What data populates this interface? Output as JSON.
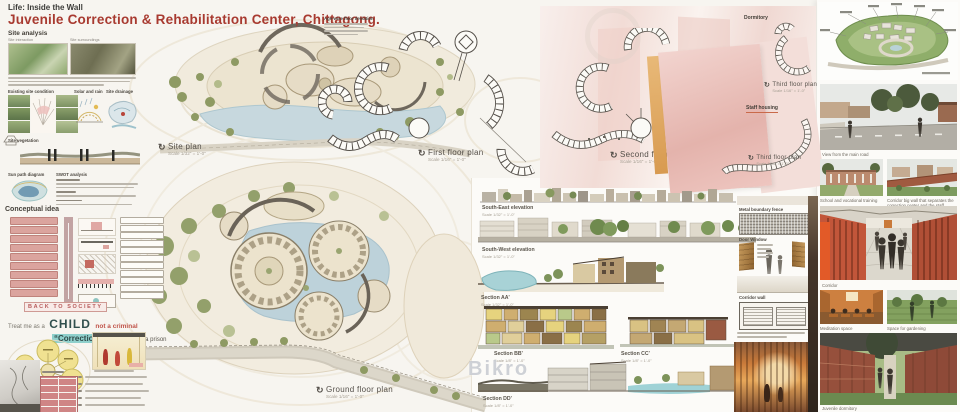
{
  "header": {
    "supertitle": "Life: Inside the Wall",
    "title": "Juvenile Correction & Rehabilitation Center, Chittagong."
  },
  "site_analysis": {
    "heading": "Site analysis",
    "thumb1_label": "Site interaction",
    "thumb2_label": "Site surroundings",
    "existing": "Existing site condition",
    "solar": "Solar and rain",
    "drainage": "Site drainage",
    "vegetation": "Site vegetation",
    "sunpath": "Sun path diagram",
    "swot": "SWOT analysis"
  },
  "conceptual": {
    "heading": "Conceptual idea",
    "back_to_society": "BACK TO SOCIETY",
    "treat_prefix": "Treat me as a",
    "treat_child": "CHILD",
    "treat_suffix": "not a criminal",
    "quote": "“Correction center”",
    "quote_suffix": "not a prison"
  },
  "plans": {
    "site_label": "Site plan",
    "site_scale": "Scale 1/32\" = 1'-0\"",
    "first_label": "First floor plan",
    "first_scale": "Scale 1/16\" = 1'-0\"",
    "second_label": "Second floor plan",
    "second_scale": "Scale 1/16\" = 1'-0\"",
    "third_label": "Third floor plan",
    "third_scale": "Scale 1/16\" = 1'-0\"",
    "ground_label": "Ground floor plan",
    "ground_scale": "Scale 1/16\" = 1'-0\""
  },
  "annotations": {
    "age_note": "Age-wise floor deviation",
    "dormitory": "Dormitory",
    "staff_housing": "Staff housing"
  },
  "drawings": {
    "se_label": "South-East elevation",
    "se_scale": "Scale 1/32\" = 1'-0\"",
    "sw_label": "South-West elevation",
    "sw_scale": "Scale 1/32\" = 1'-0\"",
    "aa_label": "Section AA'",
    "aa_scale": "Scale 1/32\" = 1'-0\"",
    "bb_label": "Section BB'",
    "bb_scale": "Scale 1/8\" = 1'-0\"",
    "cc_label": "Section CC'",
    "cc_scale": "Scale 1/8\" = 1'-0\"",
    "dd_label": "Section DD'",
    "dd_scale": "Scale 1/8\" = 1'-0\""
  },
  "details": {
    "fence": "Metal boundary fence",
    "door_window": "Door Window",
    "corridor_wall": "Corridor wall"
  },
  "renders": {
    "main_road": "View from the main road",
    "school": "School and vocational training",
    "big_wall": "Corridor big wall that separates the correction center and the staff housing",
    "corridor": "Corridor",
    "meditation": "Meditation space",
    "gardening": "Space for gardening",
    "dormitory_view": "Juvenile dormitory"
  },
  "watermark": "Bikro"
}
